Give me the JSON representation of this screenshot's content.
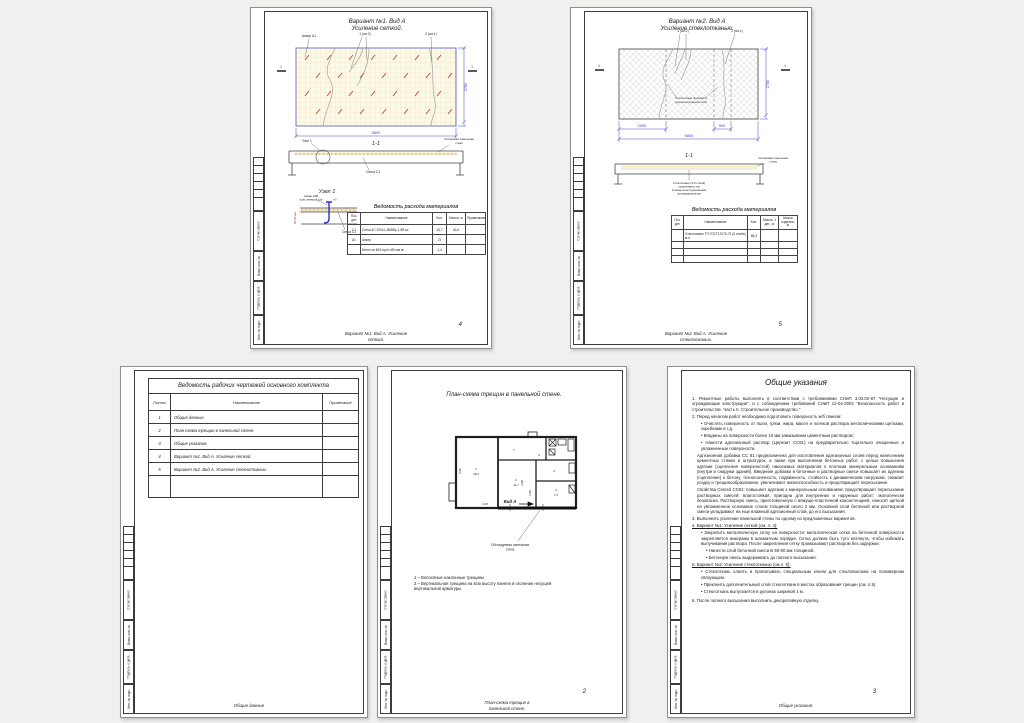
{
  "stamp": {
    "sogl": "Согласовано",
    "vzam": "Взам. инв. №",
    "podp": "Подпись и дата",
    "inv": "Инв. № подл."
  },
  "s4": {
    "title": [
      "Вариант №1. Вид А",
      "Усиление сеткой."
    ],
    "anchor_label": "Анкер А1",
    "crack1": "1 (шт.2)",
    "crack2": "2 (шт.1)",
    "sec_mark": "1",
    "dim_w": "5800",
    "dim_h": "2780",
    "sec": "1-1",
    "node_callout": "Узел 1",
    "mesh_label": "Сетка С1",
    "wall": [
      "Усиляемая панельная",
      "стена"
    ],
    "node_title": "Узел 1",
    "node_anchor": [
      "Анкер ⌀4В",
      "(шаг анкеров 1м)"
    ],
    "node_dim": "50-80 мм",
    "node_dim2": "40",
    "node_mesh": "Сетка С1",
    "tbl": {
      "title": "Ведомость расхода материалов",
      "h": [
        "Поз. дет.",
        "Наименование",
        "Кол.",
        "Масса, кг",
        "Примечание"
      ],
      "r0": {
        "pos": "С1",
        "name": "Сетка 4С 200х1,4В/5Вр-1-5В   м²",
        "qty": "15,7",
        "mass": "40,6",
        "note": ""
      },
      "r1": {
        "pos": "А1",
        "name": "Анкер",
        "qty": "21",
        "mass": "",
        "note": ""
      },
      "r2": {
        "pos": "",
        "name": "Бетон кл.В15 при t=80 мм   м²",
        "qty": "1,4",
        "mass": "",
        "note": ""
      }
    },
    "page": "4",
    "footer": [
      "Вариант №1. Вид А. Усиление",
      "сеткой."
    ]
  },
  "s5": {
    "title": [
      "Вариант №2. Вид А",
      "Усиление стеклотканью."
    ],
    "crack1": "1 (шт.2)",
    "crack2": "2 (шт.1)",
    "sec_mark": "1",
    "patch": [
      "Стеклоткань приклеить",
      "(дополнительный слой)"
    ],
    "dim_2000": "2000",
    "dim_900": "900",
    "dim_w": "5800",
    "dim_h": "2780",
    "sec": "1-1",
    "note": [
      "Стеклоткань (3-5 слоёв)",
      "приклеивать на",
      "клеяще-конструкционном",
      "полимеррастворе"
    ],
    "wall": [
      "Усиляемая панельная",
      "стена"
    ],
    "tbl": {
      "title": "Ведомость расхода материалов",
      "h": [
        "Поз. дет.",
        "Наименование",
        "Кол.",
        "Масса, 1 дет., кг",
        "Масса изделия, кг"
      ],
      "r0": {
        "pos": "",
        "name": "Стеклоткань ТП ГОСТ19170-73 (5 слоёв)   м.п.",
        "qty": "86,4",
        "m1": "",
        "m2": ""
      }
    },
    "page": "5",
    "footer": [
      "Вариант №2. Вид А. Усиление",
      "стеклотканью."
    ]
  },
  "s1": {
    "tbl_title": "Ведомость рабочих чертежей основного комплекта",
    "col_sheets": "Листы",
    "col_name": "Наименование",
    "col_note": "Примечание",
    "rows": [
      {
        "no": "1",
        "name": "Общие данные"
      },
      {
        "no": "2",
        "name": "План-схема трещин в панельной стене."
      },
      {
        "no": "3",
        "name": "Общие указания."
      },
      {
        "no": "4",
        "name": "Вариант №1. Вид А. Усиление сеткой."
      },
      {
        "no": "5",
        "name": "Вариант №2. Вид А. Усиление стеклотканью."
      }
    ],
    "footer": "Общие данные"
  },
  "s2": {
    "title": "План-схема трещин в панельной стене.",
    "room1_no": "1",
    "room1_area": "18,2",
    "room2_no": "2",
    "room2_area": "11,7",
    "room3_no": "3",
    "room3_area": "7,2",
    "l4": "4",
    "l6": "6",
    "l7": "7",
    "vid": "Вид А",
    "d315": "3,15",
    "d580": "5,80",
    "d380a": "3,80",
    "d380b": "3,80",
    "callout": [
      "Обследуемая панельная",
      "стена"
    ],
    "notes": [
      "1 – Волосяные наклонные трещины",
      "2 – Вертикальная трещина на всю высоту панели и оголение несущей",
      "вертикальной арматуры."
    ],
    "page": "2",
    "footer": [
      "План-схема трещин в",
      "панельной стене."
    ]
  },
  "s3": {
    "title": "Общие указания",
    "items": [
      "1.   Ремонтные работы выполнять в соответствии с требованиями СНиП 3.03.02-87 \"Несущие и ограждающие конструкции\", и с соблюдением требований СНиП 12-04-2002 \"Безопасность работ в строительстве. Часть II. Строительное производство.\"",
      "2.  Перед началом работ необходимо подготовить поверхность ж/б панели:",
      "•  Очистить поверхность от пыли, грязи, жира, масел и потеков раствора металлическими щетками, скребками и т.д.",
      "•  Впадины на поверхности более 10 мм замазываем цементным раствором;",
      "•  Нанести адгезионный раствор (Церезит СС81) на предварительно тщательно очищенные и увлажненные поверхности.",
      "Адгезионная добавка СС 81 предназначена для изготовления адгезионных слоев перед нанесением цементных стяжек и штукатурок, а также при выполнении бетонных работ, с целью повышения адгезии (сцепления поверхностей) наносимых материалов к плотным минеральным основаниям (внутри и снаружи зданий). Введение добавки в бетонные и растворные смеси повышает их адгезию (сцепление) к бетону, технологичность, подвижность, стойкость к динамическим нагрузкам, снижает усадку и трещинообразование, увеличивает жизнеспособность и предотвращает пересыхание.",
      "Свойства Ceresit CC81: повышает адгезию к минеральным основаниям; предотвращает пересыхание растворных смесей; влагостойкая, пригодна для внутренних и наружных работ; экологически безопасна. Растворную смесь, приготовленную с вяжуще-пластичной консистенцией, наносят щеткой на увлажненное основание слоем толщиной около 2 мм. Основной слой бетонной или растворной смеси укладывают на еще влажный адгезионный слой, до его высыхания.",
      "3.  Выполнить усиление панельной стены по одному из предложенных вариантов.",
      "4.  Вариант №1: Усиление сеткой (см. л. 4):",
      "•  Закрепить металлическую сетку на поверхности: металлическая сетка на бетонной поверхности закрепляется анкерами в шахматном порядке. Сетка должна быть туго натянута, чтобы избежать выпучивания раствора. После закрепления сетку промазывают раствором без задержки.",
      "•  Нанести слой бетонной смеси В 50-80 мм толщиной.",
      "•  Бетонную смесь выдерживать до полного высыхания.",
      "5.  Вариант №2: Усиление стеклотканью (см.л. 5):",
      "•  Стеклоткань клеить и пропитывать специальным клеем для стекловолокна на полимерном связующем.",
      "•  Приклеить дополнительный слой стеклоткани в местах образования трещин (см. л.5)",
      "•  Стеклоткань выпускается в рулонах шириной 1 м.",
      "6.  После полного высыхания выполнить декоративную отделку."
    ],
    "page": "3",
    "footer": "Общие указания."
  }
}
